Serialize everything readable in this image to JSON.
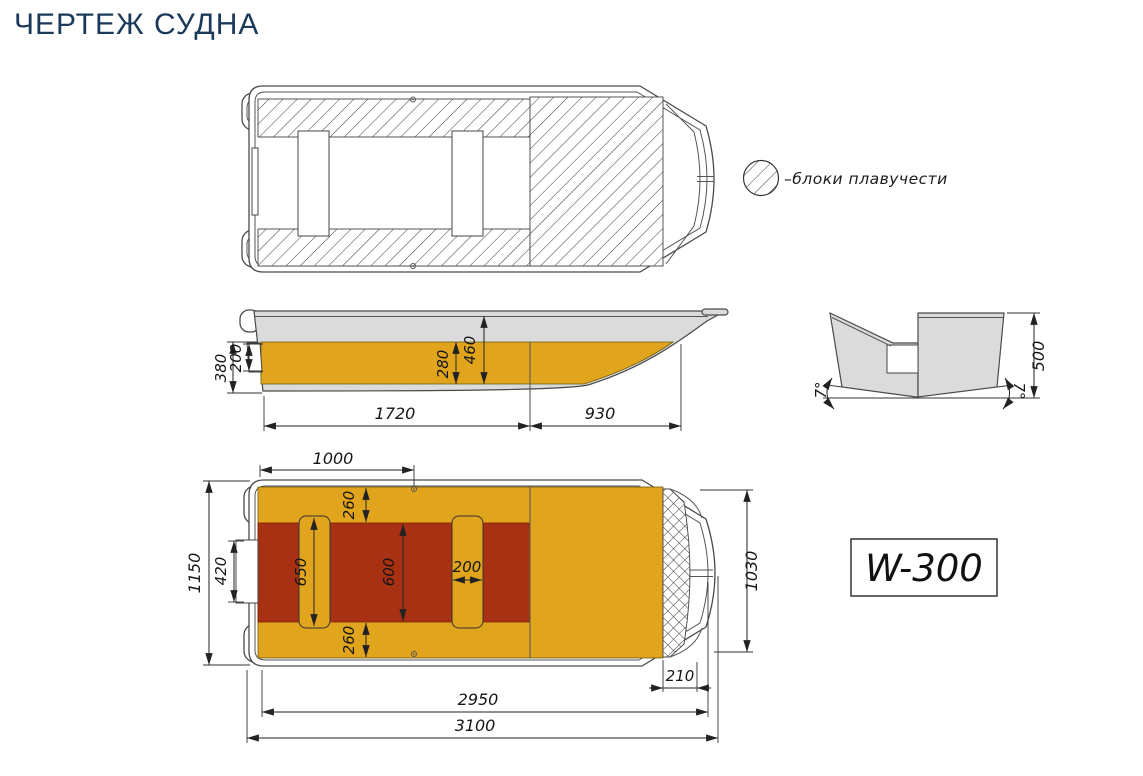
{
  "title": "ЧЕРТЕЖ СУДНА",
  "legend": {
    "symbol": "hatched-circle",
    "label": "–блоки плавучести"
  },
  "model_plate": {
    "label": "W-300"
  },
  "side_view": {
    "dims": {
      "d380": "380",
      "d200": "200",
      "d280": "280",
      "d460": "460",
      "d1720": "1720",
      "d930": "930"
    }
  },
  "transom_view": {
    "dims": {
      "d500": "500",
      "deadrise_left": "7°",
      "deadrise_right": "7°"
    }
  },
  "plan_view": {
    "dims": {
      "d1000": "1000",
      "d260_top": "260",
      "d260_bottom": "260",
      "d650": "650",
      "d600": "600",
      "d200": "200",
      "d420": "420",
      "d1150": "1150",
      "d1030": "1030",
      "d210": "210",
      "d2950": "2950",
      "d3100": "3100"
    }
  },
  "colors": {
    "accent_yellow": "#e1a51d",
    "accent_red": "#a93113",
    "hull_gray": "#dbdbdb",
    "title_navy": "#1b3a5a"
  }
}
